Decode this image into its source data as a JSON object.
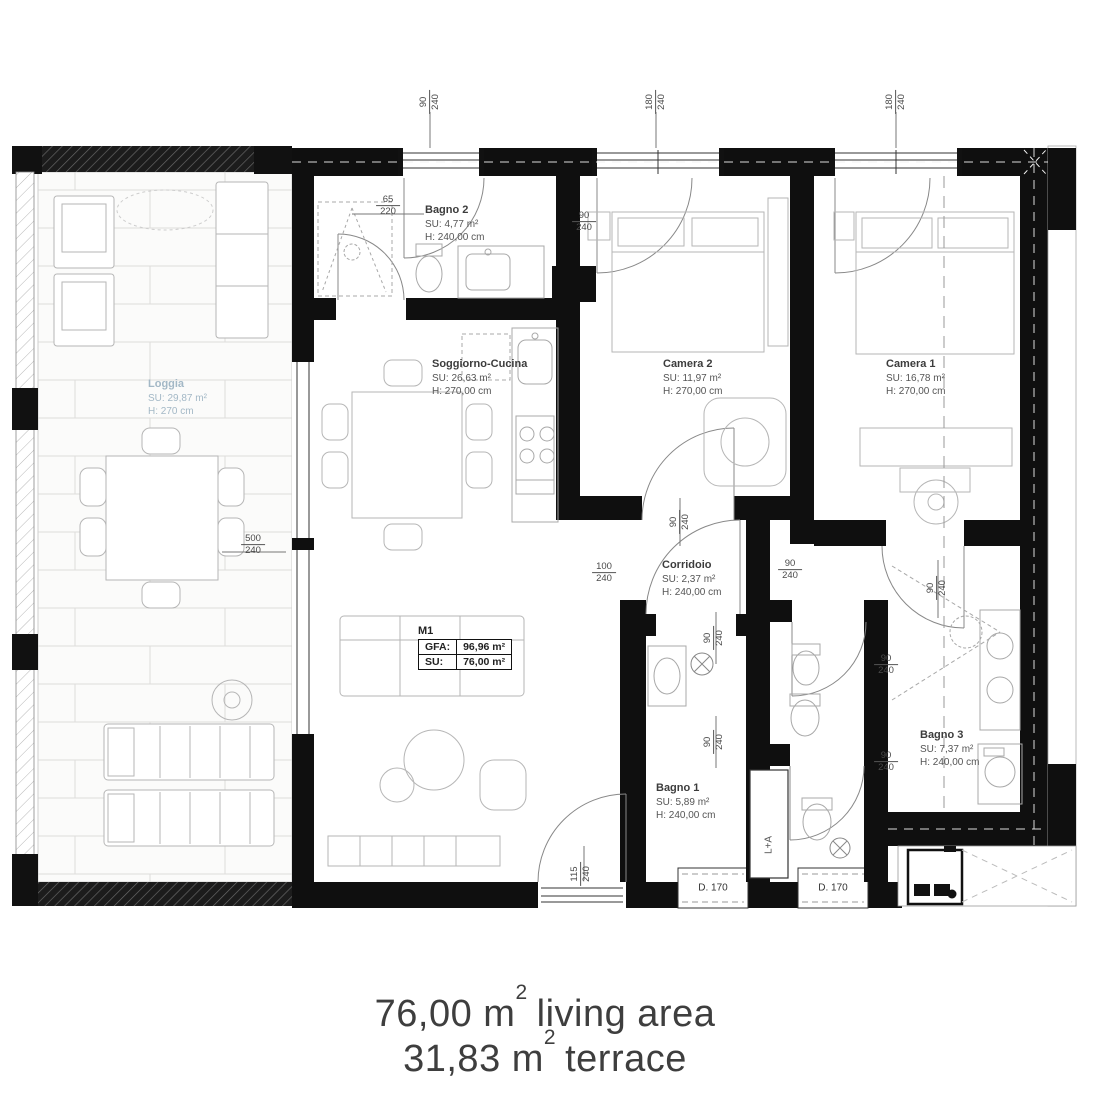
{
  "rooms": {
    "bagno2": {
      "name": "Bagno 2",
      "su": "SU: 4,77 m²",
      "h": "H: 240,00 cm"
    },
    "soggiorno": {
      "name": "Soggiorno-Cucina",
      "su": "SU: 26,63 m²",
      "h": "H: 270,00 cm"
    },
    "camera2": {
      "name": "Camera 2",
      "su": "SU: 11,97 m²",
      "h": "H: 270,00 cm"
    },
    "camera1": {
      "name": "Camera 1",
      "su": "SU: 16,78 m²",
      "h": "H: 270,00 cm"
    },
    "loggia": {
      "name": "Loggia",
      "su": "SU: 29,87 m²",
      "h": "H: 270 cm"
    },
    "corridoio": {
      "name": "Corridoio",
      "su": "SU: 2,37 m²",
      "h": "H: 240,00 cm"
    },
    "bagno1": {
      "name": "Bagno 1",
      "su": "SU: 5,89 m²",
      "h": "H: 240,00 cm"
    },
    "bagno3": {
      "name": "Bagno 3",
      "su": "SU: 7,37 m²",
      "h": "H: 240,00 cm"
    }
  },
  "unit_box": {
    "id": "M1",
    "gfa_label": "GFA:",
    "gfa_value": "96,96 m²",
    "su_label": "SU:",
    "su_value": "76,00 m²"
  },
  "dims": {
    "top1": {
      "a": "90",
      "b": "240"
    },
    "top2": {
      "a": "180",
      "b": "240"
    },
    "top3": {
      "a": "180",
      "b": "240"
    },
    "bagno2_door": {
      "a": "65",
      "b": "220"
    },
    "camera2_door": {
      "a": "90",
      "b": "240"
    },
    "loggia_door": {
      "a": "500",
      "b": "240"
    },
    "corr_top": {
      "a": "90",
      "b": "240"
    },
    "corr_left": {
      "a": "100",
      "b": "240"
    },
    "corr_right": {
      "a": "90",
      "b": "240"
    },
    "bagno3_door": {
      "a": "90",
      "b": "240"
    },
    "wc1_door": {
      "a": "90",
      "b": "240"
    },
    "wc1_right": {
      "a": "90",
      "b": "240"
    },
    "wc2_door": {
      "a": "90",
      "b": "240"
    },
    "wc2_right": {
      "a": "90",
      "b": "240"
    },
    "terrace_door": {
      "a": "115",
      "b": "240"
    }
  },
  "labels": {
    "skylight1": "D. 170",
    "skylight2": "D. 170",
    "closet": "L+A"
  },
  "caption": {
    "line1_amount": "76,00 m",
    "line1_sup": "2",
    "line1_text": "living area",
    "line2_amount": "31,83 m",
    "line2_sup": "2",
    "line2_text": "terrace"
  },
  "colors": {
    "wall": "#0f0f0f",
    "furniture": "#b6b6b6",
    "loggia_label": "#a3b8c6",
    "dim_text": "#4a4a4a"
  }
}
